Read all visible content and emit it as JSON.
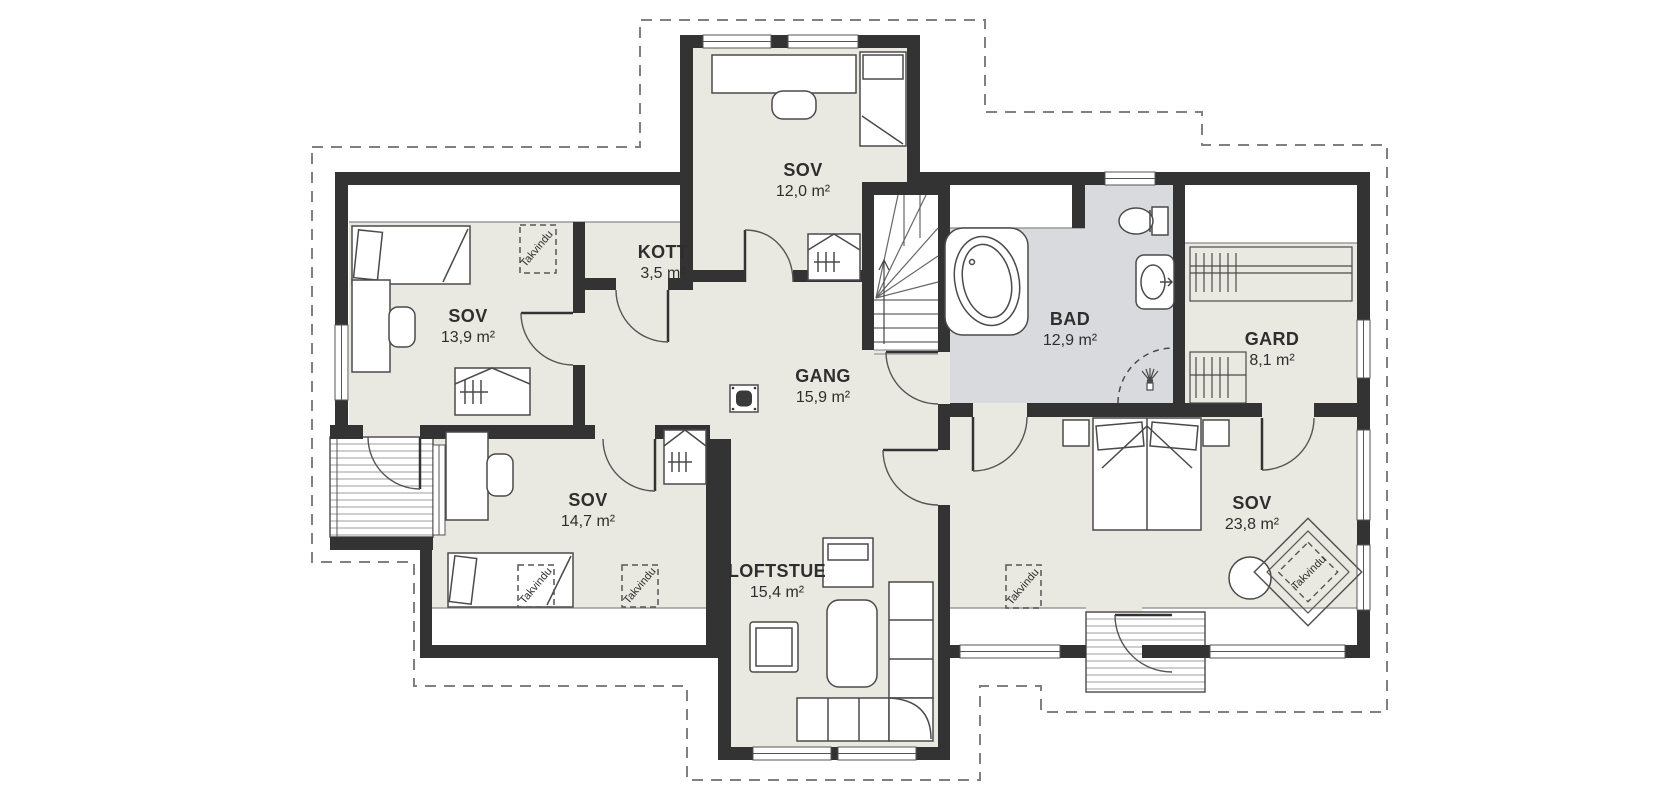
{
  "plan": {
    "title": "Loft floor plan",
    "rooms": [
      {
        "id": "sov-top",
        "name": "SOV",
        "area": "12,0 m²"
      },
      {
        "id": "kott",
        "name": "KOTT",
        "area": "3,5 m²"
      },
      {
        "id": "sov-left",
        "name": "SOV",
        "area": "13,9 m²"
      },
      {
        "id": "gang",
        "name": "GANG",
        "area": "15,9 m²"
      },
      {
        "id": "bad",
        "name": "BAD",
        "area": "12,9 m²"
      },
      {
        "id": "gard",
        "name": "GARD",
        "area": "8,1 m²"
      },
      {
        "id": "sov-bottom-left",
        "name": "SOV",
        "area": "14,7 m²"
      },
      {
        "id": "sov-right",
        "name": "SOV",
        "area": "23,8 m²"
      },
      {
        "id": "loftstue",
        "name": "LOFTSTUE",
        "area": "15,4 m²"
      }
    ],
    "annotations": {
      "roof_window": "Takvindu"
    },
    "colors": {
      "wall": "#333333",
      "floor": "#eae9e1",
      "bath_floor": "#d9dadd",
      "roof_outline": "#808080"
    }
  }
}
